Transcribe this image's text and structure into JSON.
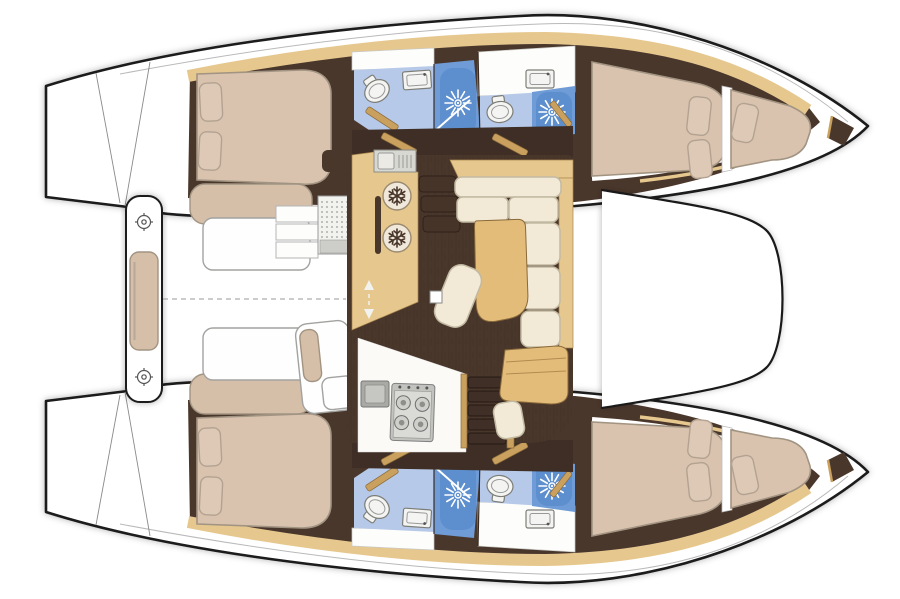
{
  "diagram": {
    "title": "Catamaran yacht interior layout — top-down floor plan",
    "type": "boat-floor-plan",
    "vessel": "sailing catamaran",
    "orientation": "bows to the right, sterns to the left",
    "summary": "4 cabins, 4 bathrooms with showers, central salon with galley and L-shaped sofa, forepeak berths, aft crossbeam bench, foredeck between the bows, dashed centerline",
    "colors": {
      "outline": "#1a1a1a",
      "floor": "#4a372c",
      "floorDark": "#3e2e25",
      "wood": "#e6c88f",
      "woodDark": "#c9a05e",
      "tableWood": "#e3bc7a",
      "bedTan": "#d9c3ae",
      "pillowTan": "#ddc9b5",
      "chaiseTan": "#d5bfa9",
      "cream": "#f2ead7",
      "creamStroke": "#c2b9a2",
      "bathBlue": "#b6c9e8",
      "showerBlue": "#6f9cd6",
      "showerDeep": "#4e84c9",
      "fixtureWhite": "#f4f4f2"
    },
    "port_hull": {
      "label": "upper hull",
      "aft_cabin": {
        "items": [
          "double berth",
          "pillow",
          "pillow",
          "settee bench"
        ]
      },
      "bathroom_aft": {
        "items": [
          "toilet",
          "washbasin",
          "shower"
        ]
      },
      "bathroom_fwd": {
        "items": [
          "toilet",
          "washbasin",
          "shower"
        ]
      },
      "forward_cabin": {
        "items": [
          "double berth",
          "pillow",
          "pillow"
        ]
      },
      "forepeak": {
        "items": [
          "berth",
          "pillow"
        ]
      }
    },
    "starboard_hull": {
      "label": "lower hull (mirror of upper hull)",
      "aft_cabin": {
        "items": [
          "double berth",
          "pillow",
          "pillow",
          "settee bench"
        ]
      },
      "bathroom_aft": {
        "items": [
          "toilet",
          "washbasin",
          "shower"
        ]
      },
      "bathroom_fwd": {
        "items": [
          "toilet",
          "washbasin",
          "shower"
        ]
      },
      "forward_cabin": {
        "items": [
          "double berth",
          "pillow",
          "pillow"
        ]
      },
      "forepeak": {
        "items": [
          "berth",
          "pillow"
        ]
      }
    },
    "salon": {
      "galley": {
        "items": [
          "sink and drainer unit",
          "top-loading fridge",
          "top-loading fridge",
          "handle rail",
          "entry steps",
          "4-burner stove",
          "worktop sink",
          "companionway stairs"
        ]
      },
      "lounge": {
        "items": [
          "L-shaped sofa",
          "dining table",
          "stool",
          "mast post",
          "nav seat",
          "nav cushion"
        ]
      },
      "floor": "dark wood plank"
    },
    "cockpit": {
      "items": [
        "aft-beam bench cushion",
        "deck hatch",
        "deck hatch",
        "side bench",
        "side bench",
        "helm steps",
        "helm grating",
        "helm seat"
      ]
    },
    "foredeck": {
      "items": [
        "trampoline area"
      ]
    },
    "centerline": "dashed"
  }
}
